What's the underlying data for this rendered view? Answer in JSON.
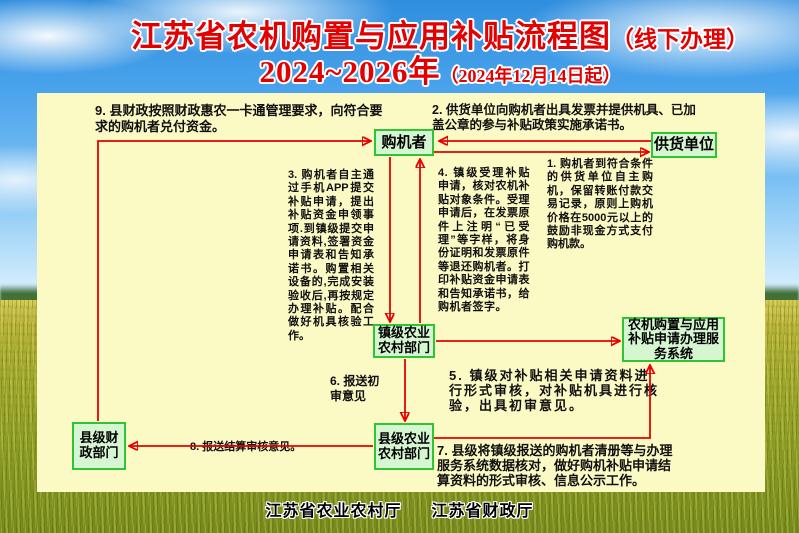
{
  "title": {
    "line1_main": "江苏省农机购置与应用补贴流程图",
    "line1_note": "（线下办理）",
    "line2_main": "2024~2026年",
    "line2_note": "（2024年12月14日起）"
  },
  "flowchart": {
    "nodes": {
      "purchaser": "购机者",
      "supplier": "供货单位",
      "town_ag_dept": "镇级农业农村部门",
      "service_system": "农机购置与应用补贴申请办理服务系统",
      "county_ag_dept": "县级农业农村部门",
      "county_finance_dept": "县级财政部门"
    },
    "steps": {
      "step1": "1. 购机者到符合条件的供货单位自主购机，保留转账付款交易记录，原则上购机价格在5000元以上的鼓励非现金方式支付购机款。",
      "step2": "2. 供货单位向购机者出具发票并提供机具、已加盖公章的参与补贴政策实施承诺书。",
      "step3": "3. 购机者自主通过手机APP提交补贴申请，提出补贴资金申领事项.到镇级提交申请资料,签署资金申请表和告知承诺书。购置相关设备的,完成安装验收后,再按规定办理补贴。配合做好机具核验工作。",
      "step4": "4. 镇级受理补贴申请，核对农机补贴对象条件。受理申请后，在发票原件上注明“已受理”等字样，将身份证明和发票原件等退还购机者。打印补贴资金申请表和告知承诺书，给购机者签字。",
      "step5": "5. 镇级对补贴相关申请资料进行形式审核，对补贴机具进行核验，出具初审意见。",
      "step6": "6. 报送初审意见",
      "step7": "7. 县级将镇级报送的购机者清册等与办理服务系统数据核对，做好购机补贴申请结算资料的形式审核、信息公示工作。",
      "step8": "8. 报送结算审核意见。",
      "step9": "9. 县财政按照财政惠农一卡通管理要求，向符合要求的购机者兑付资金。"
    }
  },
  "footer": {
    "org1": "江苏省农业农村厅",
    "org2": "江苏省财政厅"
  },
  "colors": {
    "title_red": "#e30000",
    "panel_yellow": "#fbf9c4",
    "node_fill": "#d6f6d2",
    "node_border": "#2fc435",
    "arrow_red": "#e60000",
    "text_black": "#101010"
  }
}
